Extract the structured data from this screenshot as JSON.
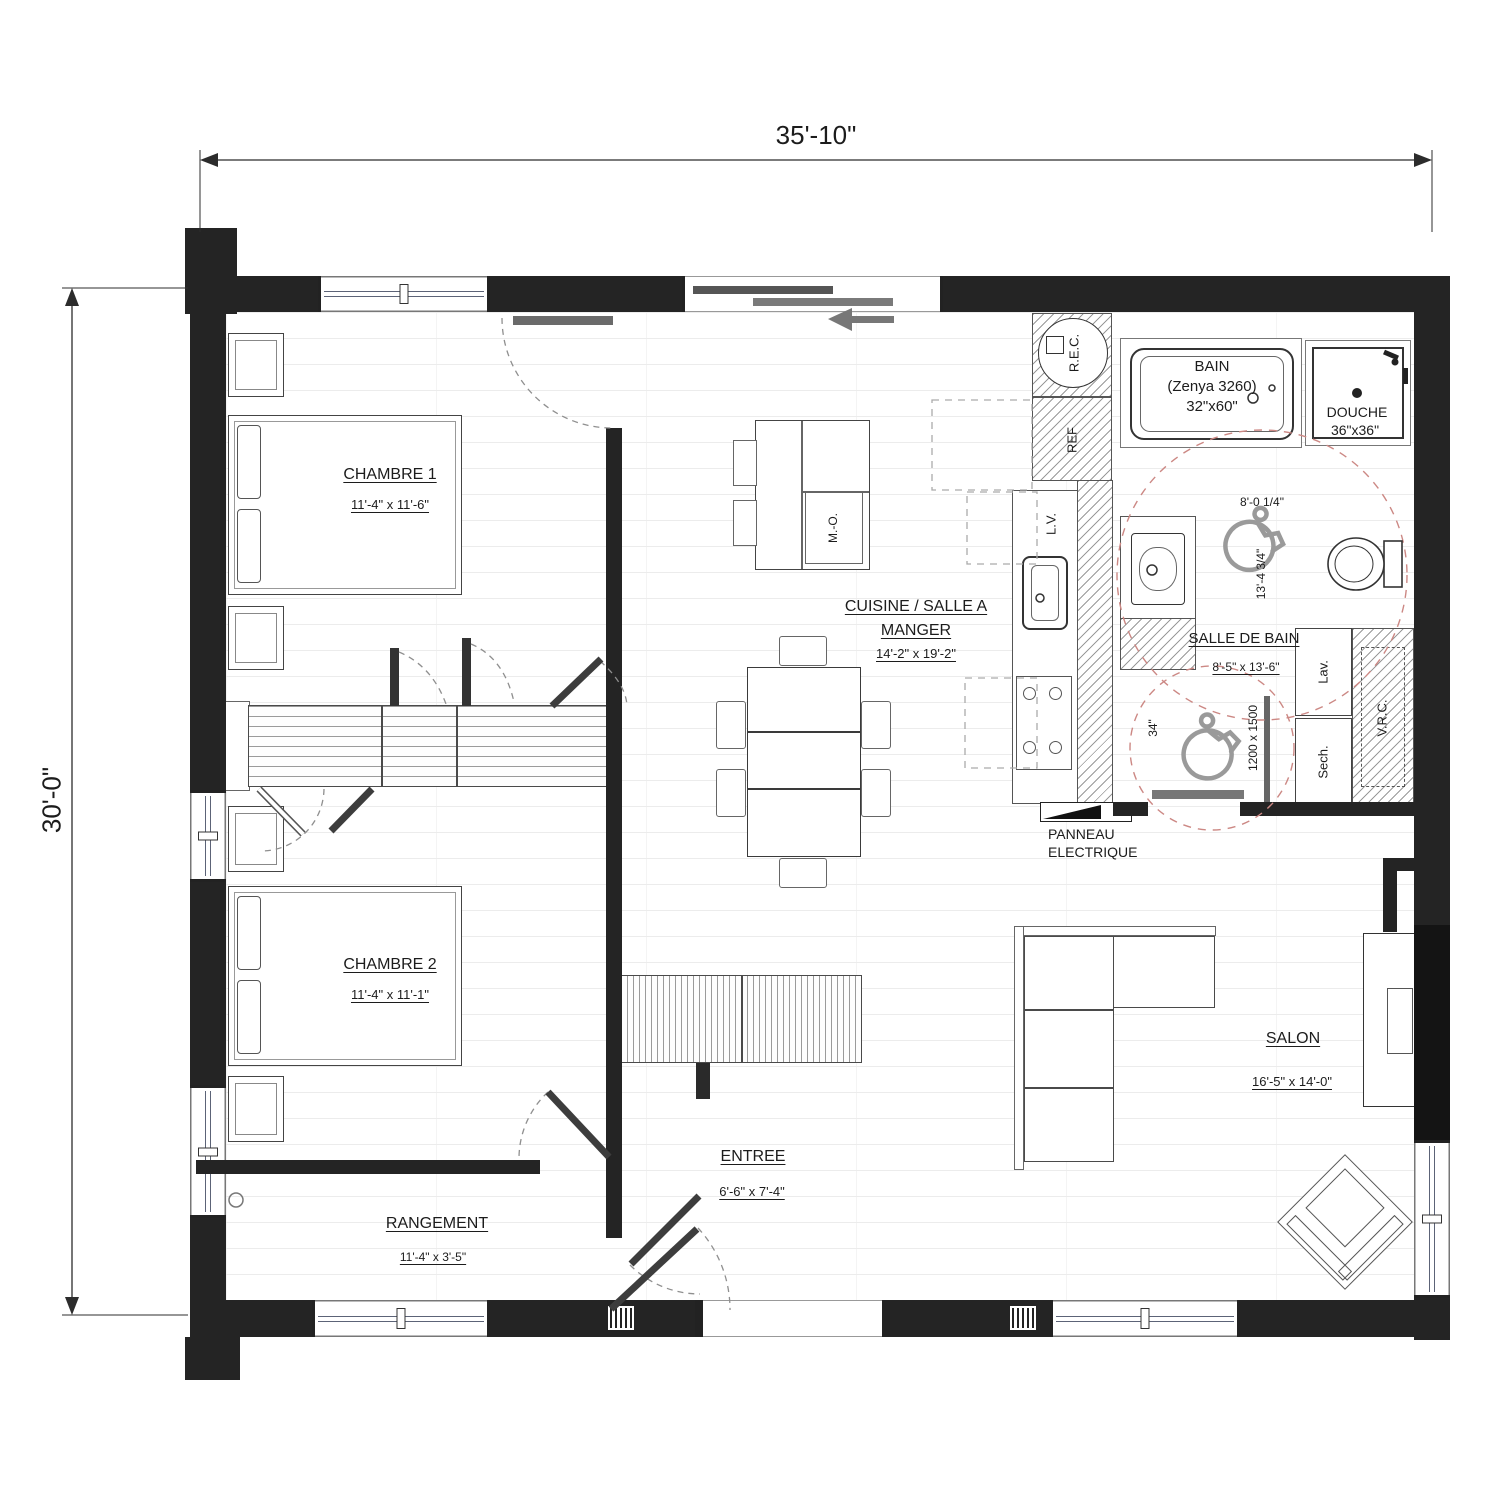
{
  "plan": {
    "overall_width": "35'-10\"",
    "overall_height": "30'-0\""
  },
  "rooms": {
    "chambre1": {
      "name": "CHAMBRE 1",
      "size": "11'-4\" x 11'-6\""
    },
    "chambre2": {
      "name": "CHAMBRE 2",
      "size": "11'-4\" x 11'-1\""
    },
    "cuisine": {
      "name1": "CUISINE / SALLE A",
      "name2": "MANGER",
      "size": "14'-2\" x 19'-2\""
    },
    "salle_de_bain": {
      "name": "SALLE DE BAIN",
      "size": "8'-5\" x 13'-6\""
    },
    "salon": {
      "name": "SALON",
      "size": "16'-5\" x 14'-0\""
    },
    "entree": {
      "name": "ENTREE",
      "size": "6'-6\" x 7'-4\""
    },
    "rangement": {
      "name": "RANGEMENT",
      "size": "11'-4\" x 3'-5\""
    }
  },
  "fixtures": {
    "bain1": "BAIN",
    "bain2": "(Zenya 3260)",
    "bain3": "32\"x60\"",
    "douche1": "DOUCHE",
    "douche2": "36\"x36\"",
    "rec": "R.E.C.",
    "ref": "REF",
    "lave_vaisselle": "L.V.",
    "micro_ondes": "M.-O.",
    "laveuse": "Lav.",
    "secheuse": "Sech.",
    "vrc": "V.R.C.",
    "panneau1": "PANNEAU",
    "panneau2": "ELECTRIQUE"
  },
  "bath_dimensions": {
    "width": "8'-0 1/4\"",
    "depth": "13'-4 3/4\"",
    "door_clearance": "34\"",
    "transfer_space": "1200 x 1500"
  },
  "colors": {
    "wall": "#242424",
    "linework": "#3d3d3d",
    "turning_circle": "#cc8884",
    "floor_line": "#ececec"
  }
}
